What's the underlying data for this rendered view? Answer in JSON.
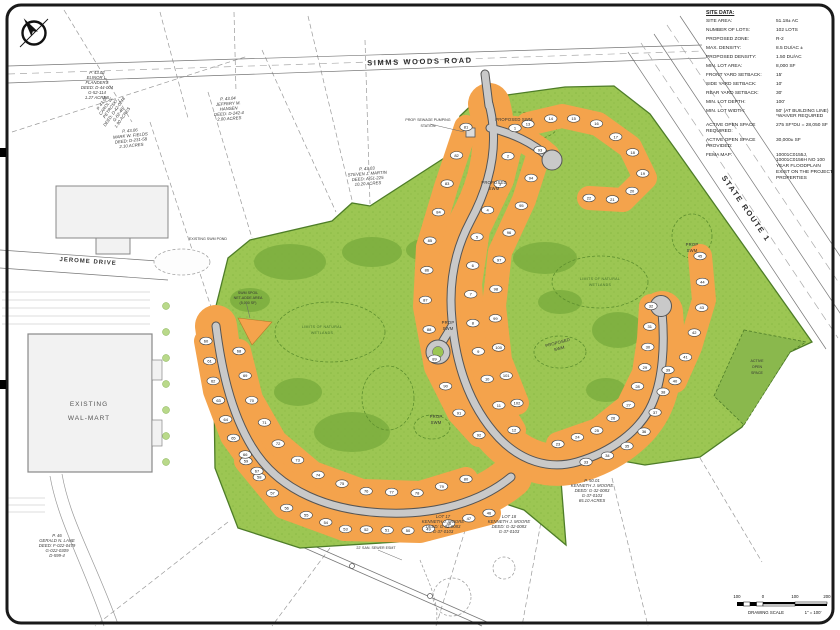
{
  "site_data": {
    "title": "SITE DATA:",
    "rows": [
      {
        "label": "SITE AREA:",
        "value": "51.18± AC"
      },
      {
        "label": "NUMBER OF LOTS:",
        "value": "102 LOTS"
      },
      {
        "label": "PROPOSED ZONE:",
        "value": "R-2"
      },
      {
        "label": "MAX. DENSITY:",
        "value": "8.5 DU/AC ±"
      },
      {
        "label": "PROPOSED DENSITY:",
        "value": "1.50 DU/AC"
      },
      {
        "label": "MIN. LOT AREA:",
        "value": "8,000 SF"
      },
      {
        "label": "FRONT YARD SETBACK:",
        "value": "15'"
      },
      {
        "label": "SIDE YARD SETBACK:",
        "value": "10'"
      },
      {
        "label": "REAR YARD SETBACK:",
        "value": "30'"
      },
      {
        "label": "MIN. LOT DEPTH:",
        "value": "100'"
      },
      {
        "label": "MIN. LOT WIDTH:",
        "value": "50' (AT BUILDING LINE) *WAIVER REQUIRED"
      },
      {
        "label": "ACTIVE OPEN SPACE REQUIRED:",
        "value": "275 SF*DU = 28,050 SF"
      },
      {
        "label": "ACTIVE OPEN SPACE PROVIDED:",
        "value": "30,000± SF"
      },
      {
        "label": "FEMA MAP:",
        "value": "10001C0155J, 10001C0156H  NO 100 YEAR FLOODPLAIN EXIST ON THE PROJECT PROPERTIES"
      }
    ]
  },
  "roads": {
    "simms_woods_road": "SIMMS WOODS ROAD",
    "state_route_1": "STATE ROUTE 1",
    "jerome_drive": "JEROME DRIVE"
  },
  "labels": {
    "existing_walmart": [
      "EXISTING",
      "WAL-MART"
    ],
    "existing_swm_pond": "EXISTING SWM POND",
    "pump_station": [
      "PROP. SEWAGE PUMPING",
      "STATION"
    ],
    "proposed_swm_top": "PROPOSED SWM",
    "proposed_swm_mid": [
      "PROPOSED",
      "SWM"
    ],
    "prop_swm_pond": [
      "PROP",
      "SWM"
    ],
    "prop_swm_bottom": [
      "PROP",
      "SWM"
    ],
    "prop_swm_east": [
      "PROP",
      "SWM"
    ],
    "proposed_swm_band": [
      "PROPOSED",
      "SWM"
    ],
    "active_open_space": [
      "ACTIVE",
      "OPEN",
      "SPACE"
    ],
    "wetlands": [
      "LIMITS OF NATURAL",
      "WETLANDS"
    ],
    "swm_spoil": [
      "SWM SPOIL",
      "NET-ADDE AREA",
      "(5,000 SF)"
    ],
    "sewer_esmt": "22' SAN. SEWER ESMT"
  },
  "parcels": [
    {
      "lines": [
        "P. 43.02",
        "ELINOR L.",
        "FLANDERS",
        "DEED: D-44-004",
        "G-52-114",
        "1.27 ACRES"
      ]
    },
    {
      "lines": [
        "P. 43.05",
        "CAROL W.",
        "PETROSKI",
        "DEED: D-42-0248",
        "G-52-48",
        "1.90 ACRES"
      ]
    },
    {
      "lines": [
        "P. 43.06",
        "MARK W. FIELDS",
        "DEED: D-231-58",
        "2.10 ACRES"
      ]
    },
    {
      "lines": [
        "P. 43.04",
        "JEFFERY M.",
        "HANSEN",
        "DEED: D-242-4",
        "2.00 ACRES"
      ]
    },
    {
      "lines": [
        "P. 43.03",
        "STEVEN J. MARTIN",
        "DEED: A-51-225",
        "10.20 ACRES"
      ]
    },
    {
      "lines": [
        "P. 46",
        "GERALD N. LANE",
        "DEED: F-022-0479",
        "G-022-0309",
        "D-599-4"
      ]
    },
    {
      "lines": [
        "LOT 17",
        "KENNETH J. MOORE",
        "DEED: G-32-0083",
        "G-37-0103"
      ]
    },
    {
      "lines": [
        "LOT 18",
        "KENNETH J. MOORE",
        "DEED: G-32-0083",
        "G-37-0103"
      ]
    },
    {
      "lines": [
        "P. 50.01",
        "KENNETH J. MOORE",
        "DEED: G-32-0083",
        "G-37-0103",
        "65.10 ACRES"
      ]
    }
  ],
  "lots": {
    "total": 102,
    "bands": [
      {
        "numbers": [
          1,
          2,
          3,
          4,
          5,
          6,
          7,
          8,
          9,
          10,
          11,
          12
        ],
        "pts": [
          [
            515,
            128
          ],
          [
            502,
            180
          ],
          [
            478,
            230
          ],
          [
            470,
            284
          ],
          [
            474,
            338
          ],
          [
            492,
            394
          ],
          [
            514,
            430
          ]
        ]
      },
      {
        "numbers": [
          13,
          14,
          15,
          16,
          17,
          18,
          19,
          20,
          21,
          22
        ],
        "pts": [
          [
            528,
            124
          ],
          [
            562,
            116
          ],
          [
            598,
            124
          ],
          [
            630,
            147
          ],
          [
            645,
            178
          ],
          [
            623,
            200
          ],
          [
            589,
            198
          ]
        ]
      },
      {
        "numbers": [
          23,
          24,
          25,
          26,
          27,
          28,
          29,
          30,
          31,
          32
        ],
        "pts": [
          [
            558,
            444
          ],
          [
            598,
            430
          ],
          [
            628,
            406
          ],
          [
            644,
            373
          ],
          [
            649,
            339
          ],
          [
            651,
            306
          ]
        ]
      },
      {
        "numbers": [
          33,
          34,
          35,
          36,
          37,
          38,
          39
        ],
        "pts": [
          [
            586,
            462
          ],
          [
            620,
            452
          ],
          [
            646,
            430
          ],
          [
            661,
            401
          ],
          [
            668,
            370
          ]
        ]
      },
      {
        "numbers": [
          45,
          44,
          43,
          42,
          41,
          40
        ],
        "pts": [
          [
            700,
            256
          ],
          [
            704,
            300
          ],
          [
            690,
            347
          ],
          [
            675,
            381
          ]
        ]
      },
      {
        "numbers": [
          59,
          58,
          57,
          56,
          55,
          54,
          53,
          52,
          51,
          50,
          49,
          48,
          47,
          46
        ],
        "pts": [
          [
            246,
            461
          ],
          [
            284,
            507
          ],
          [
            344,
            529
          ],
          [
            420,
            531
          ],
          [
            489,
            513
          ]
        ]
      },
      {
        "numbers": [
          60,
          61,
          62,
          63,
          64,
          65,
          66,
          67
        ],
        "pts": [
          [
            206,
            341
          ],
          [
            215,
            391
          ],
          [
            232,
            436
          ],
          [
            257,
            471
          ]
        ]
      },
      {
        "numbers": [
          68,
          69,
          70,
          71,
          72,
          73,
          74,
          75,
          76,
          77,
          78,
          79,
          80
        ],
        "pts": [
          [
            239,
            351
          ],
          [
            251,
            399
          ],
          [
            275,
            441
          ],
          [
            313,
            473
          ],
          [
            362,
            491
          ],
          [
            420,
            493
          ],
          [
            466,
            479
          ]
        ]
      },
      {
        "numbers": [
          81,
          82,
          83,
          84,
          85,
          86,
          87,
          88,
          89,
          90,
          91,
          92
        ],
        "pts": [
          [
            466,
            127
          ],
          [
            446,
            187
          ],
          [
            428,
            247
          ],
          [
            425,
            307
          ],
          [
            436,
            367
          ],
          [
            459,
            413
          ],
          [
            479,
            435
          ]
        ]
      },
      {
        "numbers": [
          93,
          94,
          95,
          96,
          97,
          98,
          99,
          100,
          101,
          102
        ],
        "pts": [
          [
            540,
            150
          ],
          [
            524,
            200
          ],
          [
            500,
            252
          ],
          [
            494,
            306
          ],
          [
            500,
            360
          ],
          [
            517,
            403
          ]
        ]
      }
    ]
  },
  "scale_bar": {
    "ticks": [
      "100",
      "0",
      "100",
      "200"
    ],
    "caption": "DRAWING SCALE",
    "ratio": "1\" = 100'"
  }
}
